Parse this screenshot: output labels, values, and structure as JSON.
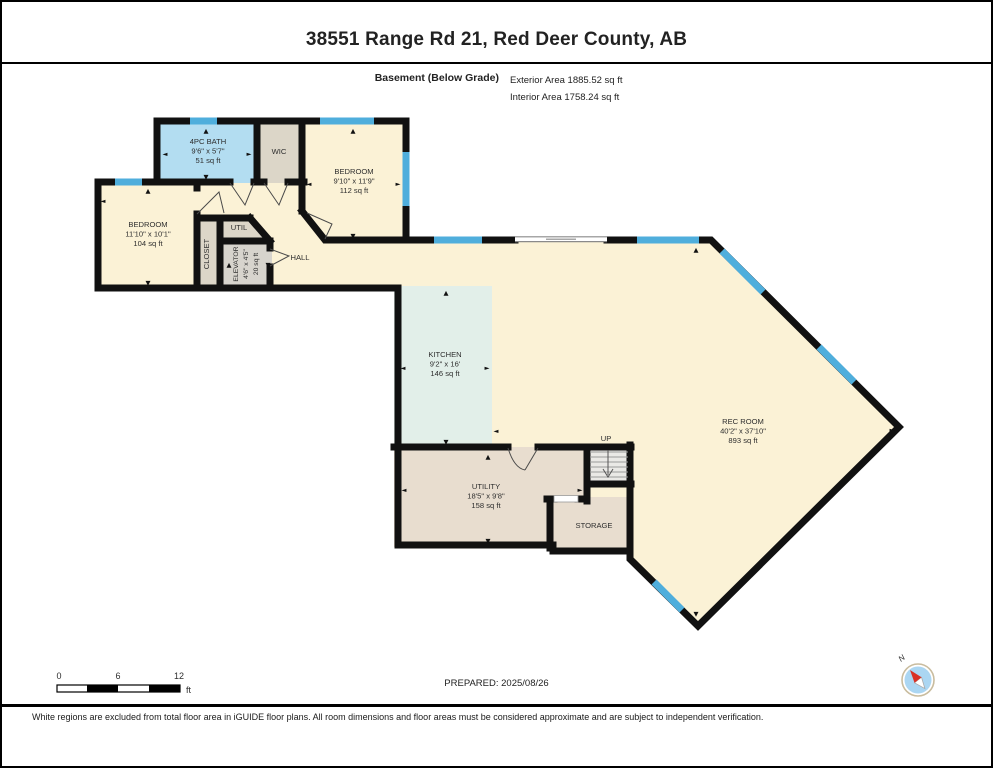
{
  "header": {
    "title": "38551 Range Rd 21, Red Deer County, AB",
    "level_label": "Basement (Below Grade)",
    "exterior_area": "Exterior Area 1885.52 sq ft",
    "interior_area": "Interior Area 1758.24 sq ft"
  },
  "rooms": {
    "bath": {
      "name": "4PC BATH",
      "dims": "9'6\" x 5'7\"",
      "area": "51 sq ft"
    },
    "wic": {
      "name": "WIC"
    },
    "bedroom_right": {
      "name": "BEDROOM",
      "dims": "9'10\" x 11'9\"",
      "area": "112 sq ft"
    },
    "bedroom_left": {
      "name": "BEDROOM",
      "dims": "11'10\" x 10'1\"",
      "area": "104 sq ft"
    },
    "closet": {
      "name": "CLOSET"
    },
    "util": {
      "name": "UTIL"
    },
    "elevator": {
      "name": "ELEVATOR",
      "dims": "4'6\" x 4'5\"",
      "area": "20 sq ft"
    },
    "hall": {
      "name": "HALL"
    },
    "kitchen": {
      "name": "KITCHEN",
      "dims": "9'2\" x 16'",
      "area": "146 sq ft"
    },
    "rec_room": {
      "name": "REC ROOM",
      "dims": "40'2\" x 37'10\"",
      "area": "893 sq ft"
    },
    "utility": {
      "name": "UTILITY",
      "dims": "18'5\" x 9'8\"",
      "area": "158 sq ft"
    },
    "storage": {
      "name": "STORAGE"
    },
    "stairs": {
      "label": "UP"
    }
  },
  "glyphs": {
    "up": "▲",
    "down": "▼",
    "left": "◄",
    "right": "►"
  },
  "scale_bar": {
    "ticks": [
      "0",
      "6",
      "12"
    ],
    "unit": "ft"
  },
  "prepared": "PREPARED: 2025/08/26",
  "compass": {
    "label": "N"
  },
  "footer": {
    "disclaimer": "White regions are excluded from total floor area in iGUIDE floor plans. All room dimensions and floor areas must be considered approximate and are subject to independent verification."
  },
  "colors": {
    "wall": "#111111",
    "window": "#4FAEDC",
    "room_cream": "#FBF2D6",
    "kitchen_mint": "#E2EFE9",
    "bath_blue": "#B3DDF1",
    "closet_gray": "#DCD6C8",
    "elevator_gray": "#D7D4CD",
    "utility_tan": "#E8DDCF",
    "stairs_gray": "#EAE9E6",
    "compass_red": "#D93025",
    "compass_blue": "#ABD6F2"
  }
}
